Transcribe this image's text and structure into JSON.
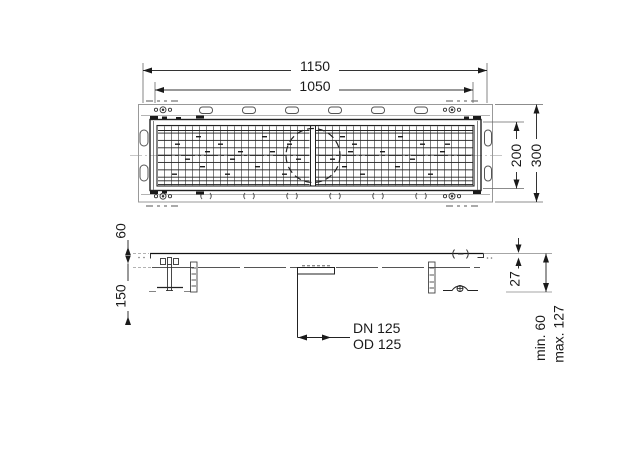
{
  "plan_view": {
    "overall_length": "1150",
    "inner_length": "1050",
    "grate_width": "200",
    "overall_width": "300"
  },
  "section_view": {
    "edge_height": "60",
    "leg_depth": "150",
    "rim_height": "27",
    "outlet_dn": "DN 125",
    "outlet_od": "OD 125",
    "install_depth_min": "min. 60",
    "install_depth_max": "max. 127"
  }
}
